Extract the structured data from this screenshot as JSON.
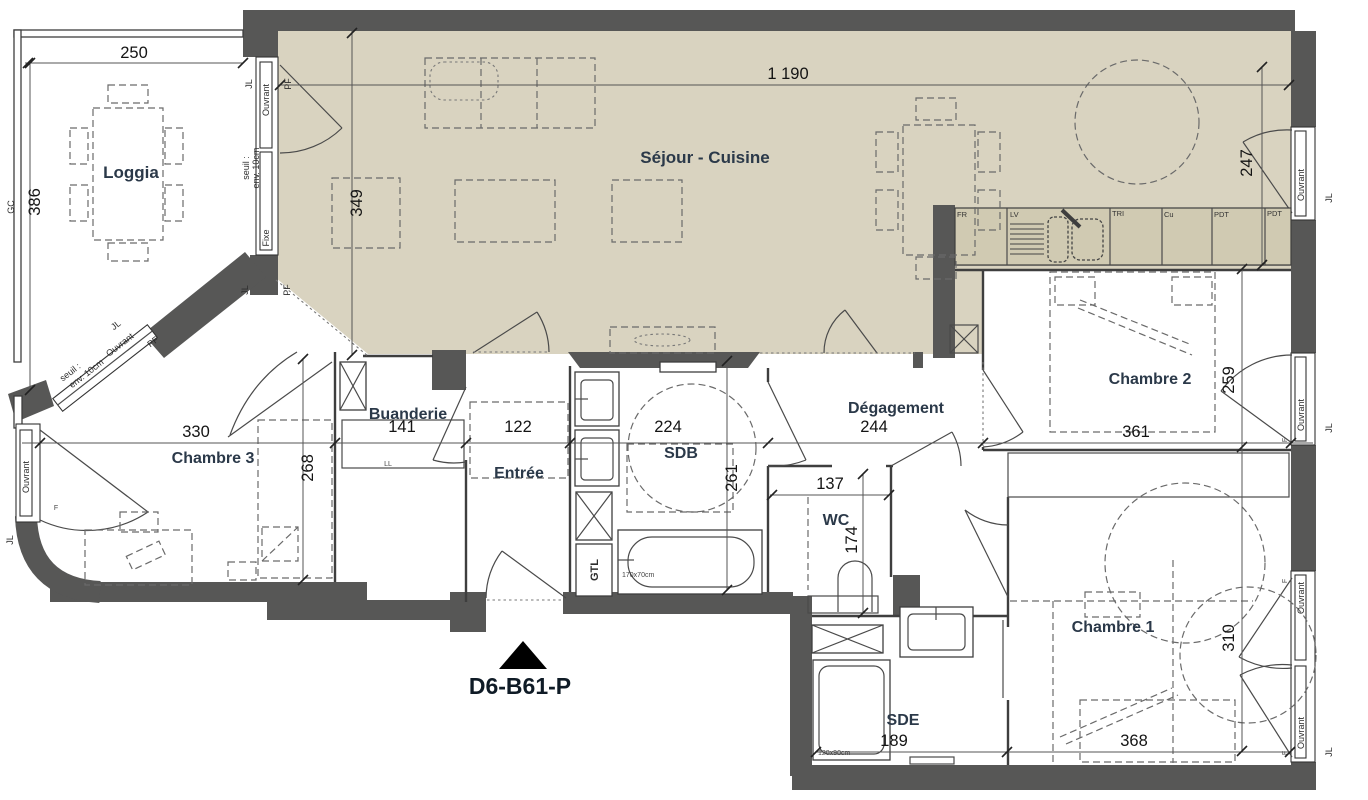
{
  "plan": {
    "id": "D6-B61-P"
  },
  "colors": {
    "wall": "#575756",
    "floor": "#d9d3c0",
    "counter": "#d0cab2",
    "background": "#ffffff"
  },
  "rooms": {
    "loggia": "Loggia",
    "sejour": "Séjour - Cuisine",
    "buanderie": "Buanderie",
    "entree": "Entrée",
    "sdb": "SDB",
    "degagement": "Dégagement",
    "wc": "WC",
    "sde": "SDE",
    "chambre1": "Chambre 1",
    "chambre2": "Chambre 2",
    "chambre3": "Chambre 3"
  },
  "dims": {
    "loggia_w": "250",
    "loggia_h": "386",
    "sejour_w": "1 190",
    "sejour_h": "349",
    "sejour_right": "247",
    "chambre3_w": "330",
    "chambre3_h": "268",
    "buanderie_w": "141",
    "entree_w": "122",
    "sdb_w": "224",
    "sdb_h": "261",
    "degagement_w": "244",
    "chambre2_w": "361",
    "chambre2_h": "259",
    "wc_w": "137",
    "wc_h": "174",
    "sde_w": "189",
    "chambre1_w": "368",
    "chambre1_h": "310"
  },
  "window_labels": {
    "jl": "JL",
    "ouvrant": "Ouvrant",
    "fixe": "Fixe",
    "pf": "PF",
    "f": "F",
    "seuil_line1": "seuil :",
    "seuil_line2": "env. 10cm"
  },
  "annotations": {
    "gc": "GC",
    "gtl": "GTL",
    "ll": "LL",
    "bathtub_size": "170x70cm",
    "shower_size": "120x90cm"
  },
  "kitchen": {
    "fr": "FR",
    "lv": "LV",
    "tri": "TRI",
    "cu": "Cu",
    "pdt": "PDT"
  }
}
